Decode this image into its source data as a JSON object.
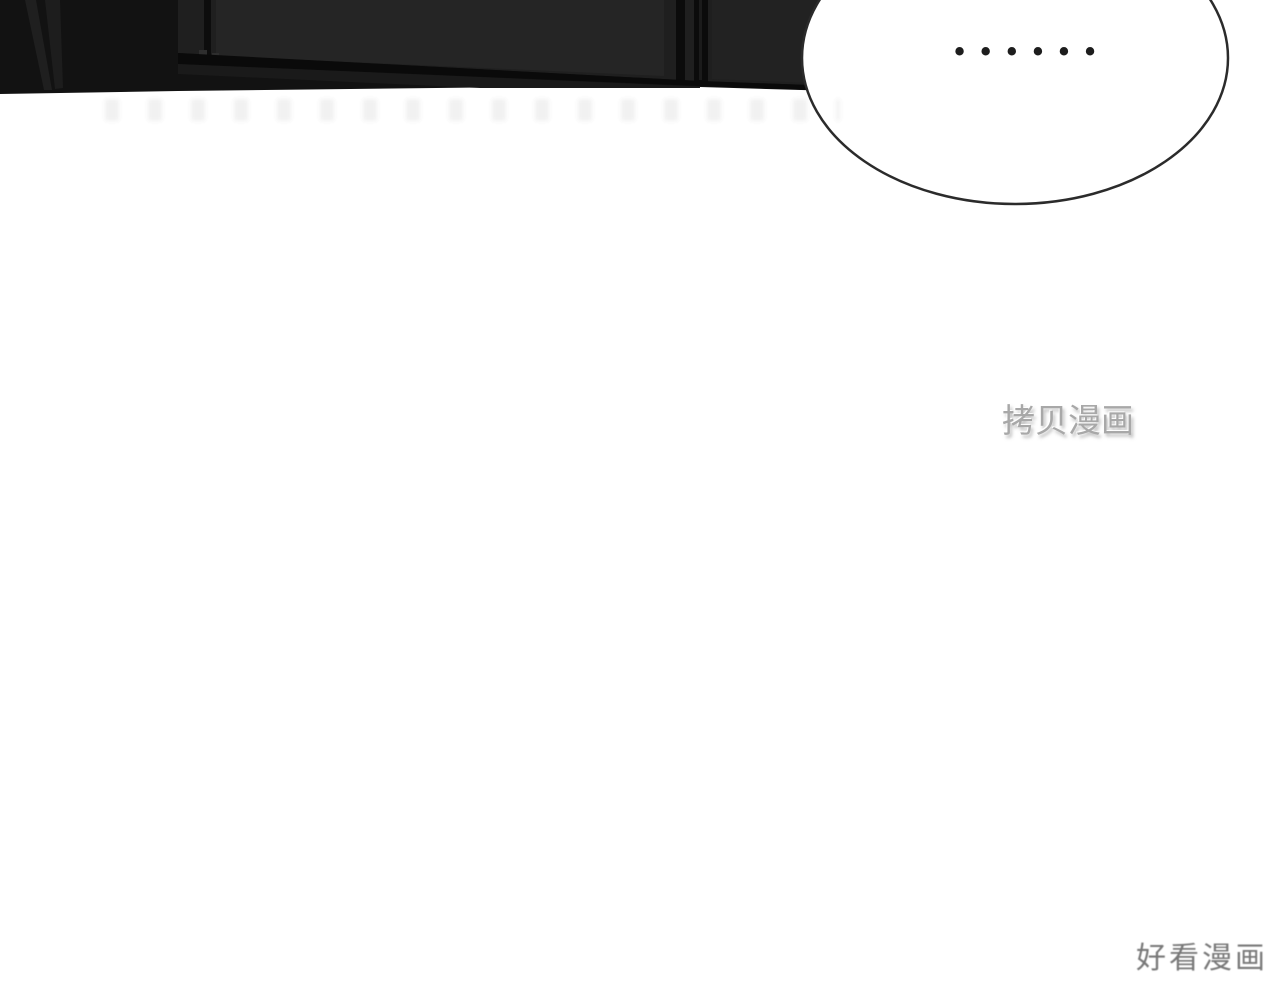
{
  "page": {
    "background_color": "#ffffff"
  },
  "top_panel": {
    "base_color": "#121212",
    "shade_color": "#1f1f1f",
    "highlight_shade_color": "#252525",
    "band_color": "#0a0a0a"
  },
  "speech_bubble": {
    "text": "••••••",
    "fill_color": "#ffffff",
    "outline_color": "#2b2b2b"
  },
  "watermarks": {
    "kaobei_manhua": "拷贝漫画",
    "kaobei_color": "#a8a8a8",
    "haokan_manhua": "好看漫画",
    "haokan_color": "#787878"
  }
}
